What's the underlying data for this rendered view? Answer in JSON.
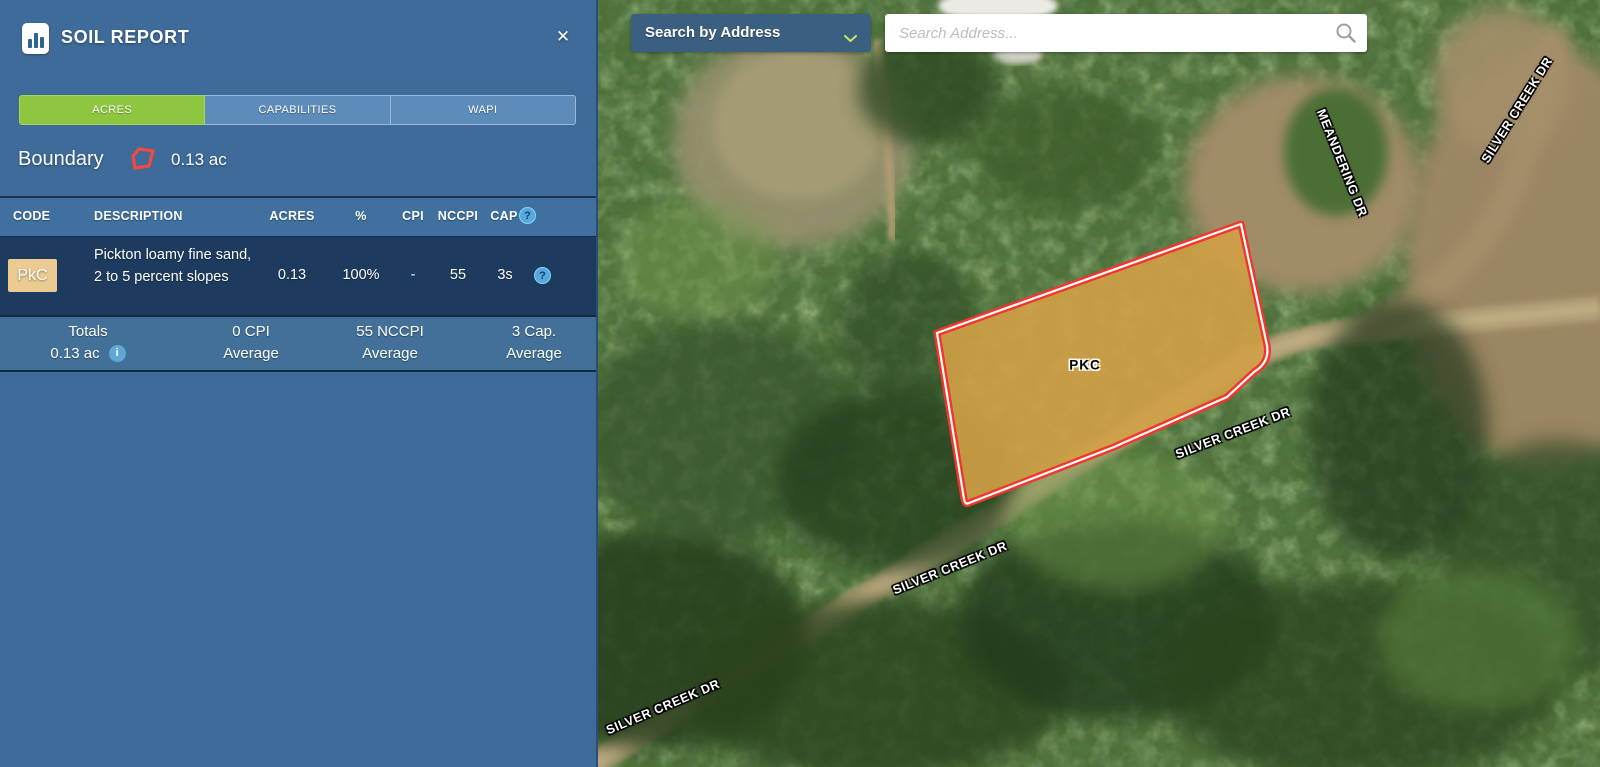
{
  "panel": {
    "title": "SOIL REPORT",
    "close_glyph": "✕",
    "tabs": [
      {
        "label": "ACRES",
        "active": true
      },
      {
        "label": "CAPABILITIES",
        "active": false
      },
      {
        "label": "WAPI",
        "active": false
      }
    ],
    "boundary": {
      "label": "Boundary",
      "area": "0.13 ac"
    },
    "table": {
      "col_code": "CODE",
      "col_description": "DESCRIPTION",
      "col_acres": "ACRES",
      "col_percent": "%",
      "col_cpi": "CPI",
      "col_nccpi": "NCCPI",
      "col_cap": "CAP",
      "help_glyph": "?",
      "info_glyph": "i",
      "row": {
        "code": "PkC",
        "description": "Pickton loamy fine sand, 2 to 5 percent slopes",
        "acres": "0.13",
        "percent": "100%",
        "cpi": "-",
        "nccpi": "55",
        "cap": "3s"
      },
      "totals": {
        "label": "Totals",
        "area": "0.13 ac",
        "cpi": "0 CPI",
        "cpi_sub": "Average",
        "nccpi": "55 NCCPI",
        "nccpi_sub": "Average",
        "cap": "3 Cap.",
        "cap_sub": "Average"
      }
    }
  },
  "map": {
    "search_mode": "Search by Address",
    "search_placeholder": "Search Address...",
    "parcel_label": "PKC",
    "road_labels": [
      {
        "text": "SILVER CREEK DR"
      },
      {
        "text": "MEANDERING DR"
      },
      {
        "text": "SILVER CREEK DR"
      },
      {
        "text": "SILVER CREEK DR"
      },
      {
        "text": "SILVER CREEK DR"
      }
    ]
  },
  "colors": {
    "panel_blue": "#3e6b99",
    "table_header_blue": "#40709f",
    "row_dark_navy": "#1d3b5e",
    "totals_blue": "#427098",
    "active_tab_green": "#8dc63f",
    "inactive_tab_blue": "#5d8bba",
    "soil_badge_tan": "#eccb92",
    "help_icon_blue": "#52aadf",
    "parcel_fill_orange": "#d1a046",
    "parcel_stroke_red": "#f2362b",
    "dropdown_blue": "#3a5f80",
    "chevron_green": "#cde26a"
  }
}
